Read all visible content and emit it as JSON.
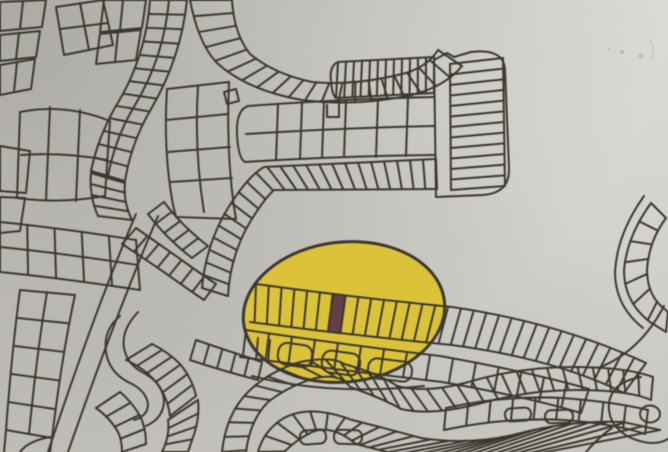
{
  "meta": {
    "description": "Photographed cadastral subdivision plot map with curving streets lined by narrow plots; a yellow highlighter ellipse marks one block and a single plot inside it is shaded maroon",
    "width": 668,
    "height": 452
  },
  "colors": {
    "paper": "#d7d5cf",
    "ink": "#3a382f",
    "highlight_yellow": "#ddc233",
    "marked_plot_maroon": "#643f45"
  },
  "highlight": {
    "shape": "ellipse",
    "center_x": 344,
    "center_y": 312,
    "radius_x": 101,
    "radius_y": 70,
    "rotation_deg": -6
  },
  "marked_plot": {
    "strip": "upper plot strip inside highlight ellipse",
    "position_from_left": 7,
    "color_key": "marked_plot_maroon"
  }
}
